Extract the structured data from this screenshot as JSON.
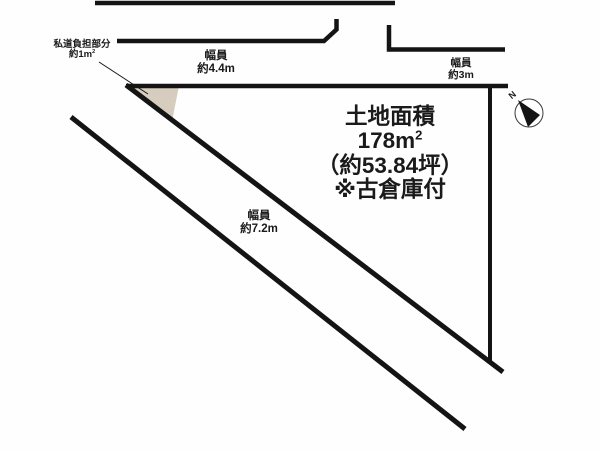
{
  "diagram": {
    "type": "land-plot-layout",
    "labels": {
      "private_road": {
        "line1": "私道負担部分",
        "line2_prefix": "約1m",
        "line2_sup": "2"
      },
      "road_top": {
        "line1": "幅員",
        "line2": "約4.4m"
      },
      "road_right": {
        "line1": "幅員",
        "line2": "約3m"
      },
      "road_diagonal": {
        "line1": "幅員",
        "line2": "約7.2m"
      },
      "area": {
        "line1": "土地面積",
        "line2_prefix": "178m",
        "line2_sup": "2",
        "line3": "（約53.84坪）",
        "line4": "※古倉庫付"
      },
      "compass_north": "N"
    },
    "colors": {
      "line": "#141414",
      "triangle_fill": "#d7cdbf",
      "background": "#fefefe",
      "compass_ring": "#3a3a3a"
    }
  }
}
